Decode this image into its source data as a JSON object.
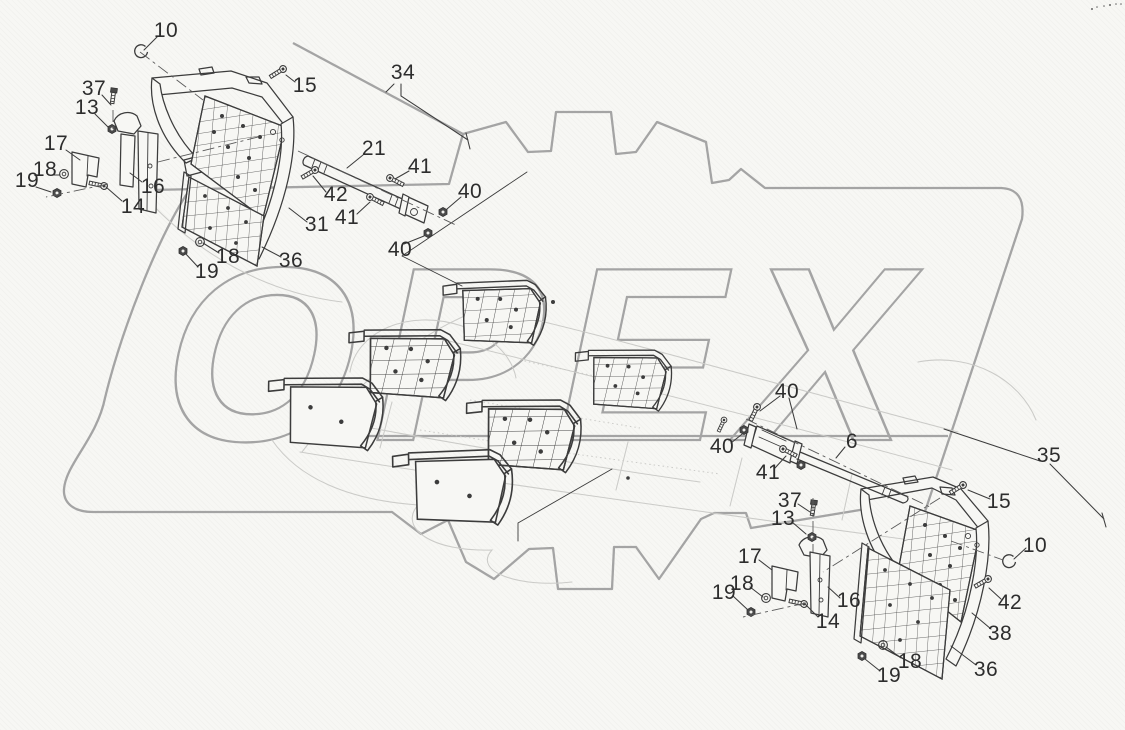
{
  "watermark": {
    "text": "OPEX"
  },
  "colors": {
    "background": "#f7f7f4",
    "linework": "#3c3c3c",
    "watermark_gray": "#a4a4a4",
    "chassis_sketch_gray": "#cbcbc8"
  },
  "diagram": {
    "type": "exploded-parts-diagram",
    "callouts": [
      {
        "label": "10",
        "x": 166,
        "y": 31
      },
      {
        "label": "15",
        "x": 305,
        "y": 86
      },
      {
        "label": "34",
        "x": 403,
        "y": 73
      },
      {
        "label": "37",
        "x": 94,
        "y": 89
      },
      {
        "label": "13",
        "x": 87,
        "y": 108
      },
      {
        "label": "17",
        "x": 56,
        "y": 144
      },
      {
        "label": "18",
        "x": 45,
        "y": 170
      },
      {
        "label": "19",
        "x": 27,
        "y": 181
      },
      {
        "label": "16",
        "x": 153,
        "y": 187
      },
      {
        "label": "14",
        "x": 133,
        "y": 207
      },
      {
        "label": "21",
        "x": 374,
        "y": 149
      },
      {
        "label": "41",
        "x": 420,
        "y": 167
      },
      {
        "label": "42",
        "x": 336,
        "y": 195
      },
      {
        "label": "40",
        "x": 470,
        "y": 192
      },
      {
        "label": "41",
        "x": 347,
        "y": 218
      },
      {
        "label": "40",
        "x": 400,
        "y": 250
      },
      {
        "label": "31",
        "x": 317,
        "y": 225
      },
      {
        "label": "36",
        "x": 291,
        "y": 261
      },
      {
        "label": "18",
        "x": 228,
        "y": 257
      },
      {
        "label": "19",
        "x": 207,
        "y": 272
      },
      {
        "label": "40",
        "x": 787,
        "y": 392
      },
      {
        "label": "40",
        "x": 722,
        "y": 447
      },
      {
        "label": "41",
        "x": 768,
        "y": 473
      },
      {
        "label": "6",
        "x": 852,
        "y": 442
      },
      {
        "label": "35",
        "x": 1049,
        "y": 456
      },
      {
        "label": "15",
        "x": 999,
        "y": 502
      },
      {
        "label": "37",
        "x": 790,
        "y": 501
      },
      {
        "label": "13",
        "x": 783,
        "y": 519
      },
      {
        "label": "17",
        "x": 750,
        "y": 557
      },
      {
        "label": "18",
        "x": 742,
        "y": 584
      },
      {
        "label": "19",
        "x": 724,
        "y": 593
      },
      {
        "label": "16",
        "x": 849,
        "y": 601
      },
      {
        "label": "14",
        "x": 828,
        "y": 622
      },
      {
        "label": "10",
        "x": 1035,
        "y": 546
      },
      {
        "label": "42",
        "x": 1010,
        "y": 603
      },
      {
        "label": "38",
        "x": 1000,
        "y": 634
      },
      {
        "label": "36",
        "x": 986,
        "y": 670
      },
      {
        "label": "18",
        "x": 910,
        "y": 662
      },
      {
        "label": "19",
        "x": 889,
        "y": 676
      }
    ]
  }
}
